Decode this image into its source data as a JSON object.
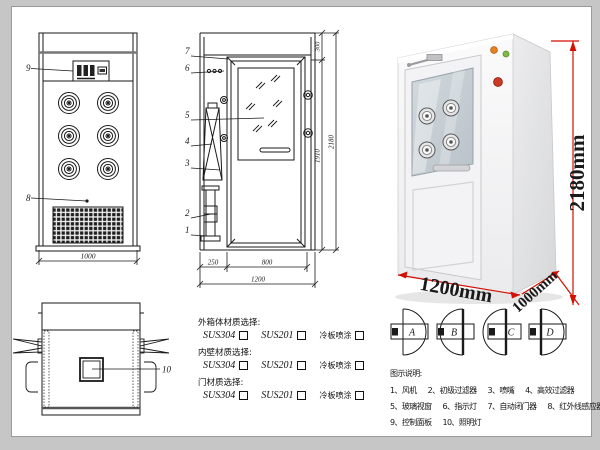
{
  "frame": {
    "bg": "#c6c6c6",
    "page_bg": "#ffffff",
    "line_color": "#1a1a1a"
  },
  "front_view": {
    "part9": "9",
    "part8": "8",
    "dim_width": "1000"
  },
  "section_view": {
    "part1": "1",
    "part2": "2",
    "part3": "3",
    "part4": "4",
    "part5": "5",
    "part6": "6",
    "part7": "7",
    "dim_top": "300",
    "dim_inner_height": "1910",
    "dim_total_height": "2180",
    "dim_left": "250",
    "dim_door_width": "800",
    "dim_total_width": "1200"
  },
  "photo": {
    "dim_height": "2180mm",
    "dim_width": "1200mm",
    "dim_depth": "1000mm",
    "dim_color": "#d40f00"
  },
  "top_view": {
    "part10": "10"
  },
  "materials": {
    "groups": [
      {
        "title": "外箱体材质选择:",
        "options": [
          "SUS304",
          "SUS201",
          "冷板喷涂"
        ]
      },
      {
        "title": "内壁材质选择:",
        "options": [
          "SUS304",
          "SUS201",
          "冷板喷涂"
        ]
      },
      {
        "title": "门材质选择:",
        "options": [
          "SUS304",
          "SUS201",
          "冷板喷涂"
        ]
      }
    ]
  },
  "door_configs": {
    "items": [
      "A",
      "B",
      "C",
      "D"
    ]
  },
  "legend": {
    "title": "图示说明:",
    "items": [
      "1、风机",
      "2、初级过滤器",
      "3、喷嘴",
      "4、高效过滤器",
      "5、玻璃视窗",
      "6、指示灯",
      "7、自动闭门器",
      "8、红外线感应器",
      "9、控制面板",
      "10、照明灯"
    ]
  }
}
